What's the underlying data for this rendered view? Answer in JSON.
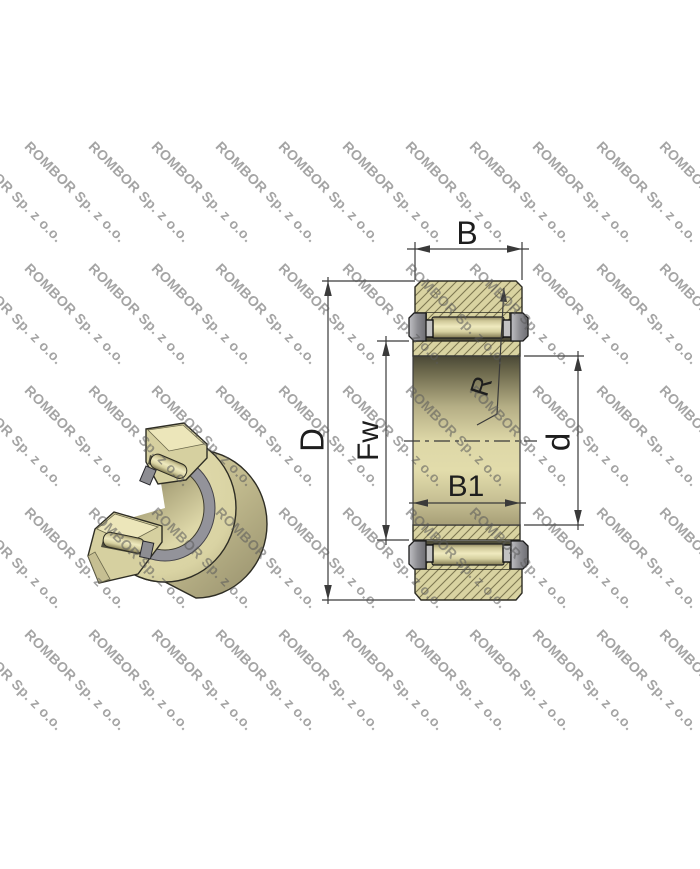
{
  "watermark": {
    "text": "ROMBOR Sp. z o.o."
  },
  "drawing": {
    "labels": {
      "outer_ring_width": "B",
      "outer_diameter": "D",
      "raceway_diameter": "Fw",
      "outer_surface_radius": "R",
      "bore_diameter": "d",
      "inner_ring_width": "B1"
    }
  },
  "colors": {
    "background": "#ffffff",
    "bearing_tan": "#d9d3a1",
    "bearing_tan_light": "#ece6ba",
    "hatch_line": "#7e7852",
    "flange_gray": "#8e8e93",
    "pocket_dark": "#4f4d3a",
    "drawing_line": "#3a3a3a",
    "watermark_gray": "#5a5a5a"
  }
}
